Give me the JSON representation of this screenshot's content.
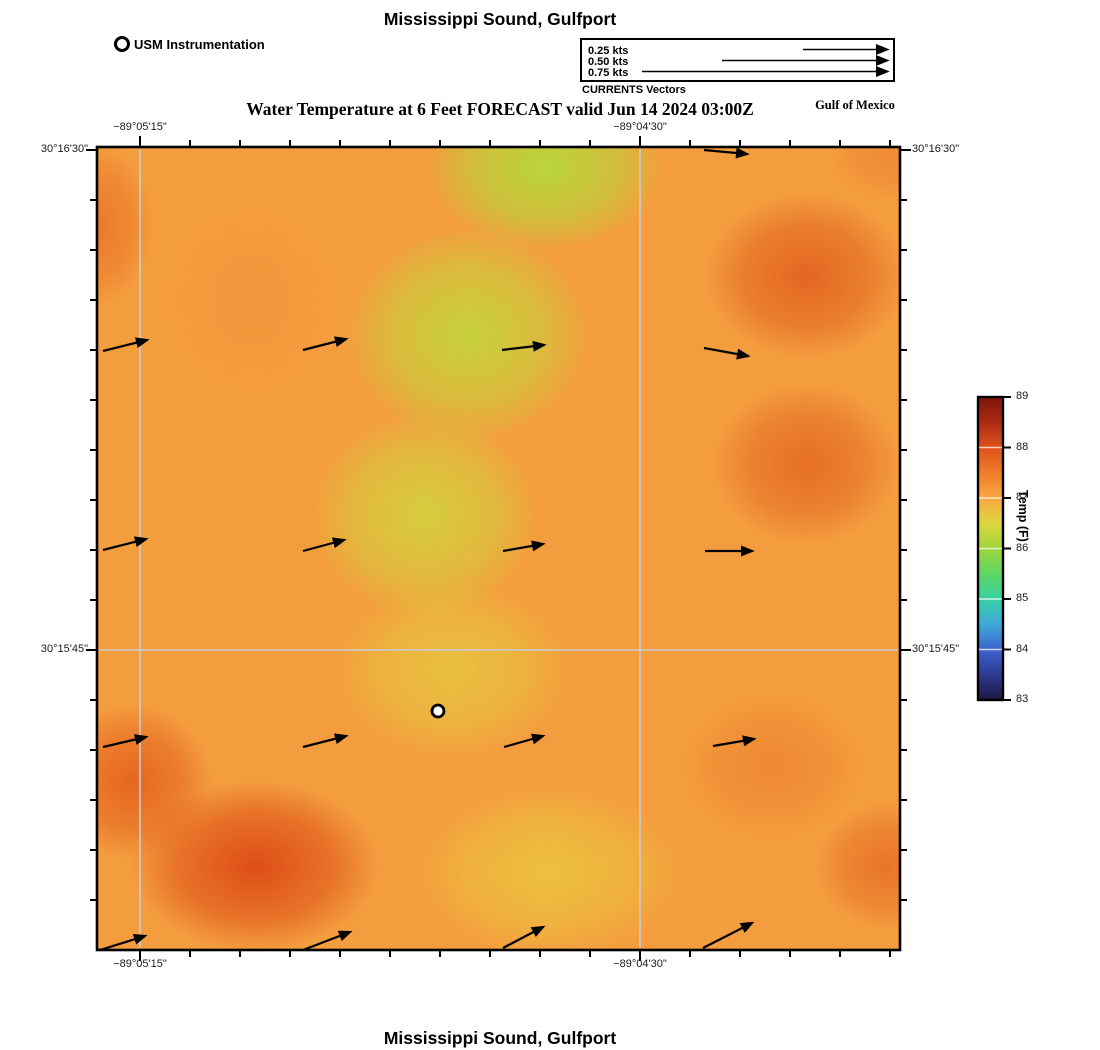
{
  "page": {
    "title_top": "Mississippi Sound, Gulfport",
    "title_bottom": "Mississippi Sound, Gulfport",
    "subtitle": "Water Temperature at 6 Feet FORECAST valid Jun 14 2024 03:00Z",
    "region_label": "Gulf of Mexico"
  },
  "instrument_legend": {
    "label": "USM Instrumentation"
  },
  "currents_legend": {
    "title": "CURRENTS Vectors",
    "head_x": 887,
    "row_ys": [
      49.5,
      60.5,
      71.5
    ],
    "entries": [
      {
        "label": "0.25 kts",
        "tail_x": 803
      },
      {
        "label": "0.50 kts",
        "tail_x": 722
      },
      {
        "label": "0.75 kts",
        "tail_x": 642
      }
    ]
  },
  "axes": {
    "minor_tick_step_px": 50,
    "top_ticks": [
      {
        "label": "−89°05'15\"",
        "x": 140
      },
      {
        "label": "−89°04'30\"",
        "x": 640
      }
    ],
    "bottom_ticks": [
      {
        "label": "−89°05'15\"",
        "x": 140
      },
      {
        "label": "−89°04'30\"",
        "x": 640
      }
    ],
    "left_ticks": [
      {
        "label": "30°16'30\"",
        "y": 150
      },
      {
        "label": "30°15'45\"",
        "y": 650
      }
    ],
    "right_ticks": [
      {
        "label": "30°16'30\"",
        "y": 150
      },
      {
        "label": "30°15'45\"",
        "y": 650
      }
    ],
    "gridlines_x": [
      140,
      640
    ],
    "gridlines_y": [
      650
    ]
  },
  "colorbar": {
    "label": "Temp (F)",
    "min": 83,
    "max": 89,
    "ticks": [
      83,
      84,
      85,
      86,
      87,
      88,
      89
    ],
    "colors_bottom_to_top": [
      "#1d1746",
      "#2c3a8e",
      "#3c64cf",
      "#3fa9da",
      "#38d0a4",
      "#5ed763",
      "#9fd63c",
      "#ddd63e",
      "#f9a743",
      "#f17c2b",
      "#df521c",
      "#ab2a13",
      "#7c150c"
    ],
    "geometry": {
      "left": 978,
      "top": 397,
      "width": 25,
      "height": 303
    }
  },
  "chart_data": {
    "type": "heatmap",
    "title": "Mississippi Sound, Gulfport",
    "subtitle": "Water Temperature at 6 Feet FORECAST valid Jun 14 2024 03:00Z",
    "value_label": "Temp (F)",
    "value_range": [
      83,
      89
    ],
    "x_axis_ticks": [
      "−89°05'15\"",
      "−89°04'30\""
    ],
    "y_axis_ticks": [
      "30°16'30\"",
      "30°15'45\""
    ],
    "plot_px": {
      "left": 97,
      "top": 147,
      "width": 803,
      "height": 803
    },
    "approx_temperature_regions_f": [
      {
        "region": "background field",
        "temp_f": 87.2
      },
      {
        "region": "diagonal band top-center to mid-left (green)",
        "temp_f": 86.2
      },
      {
        "region": "lower-center (yellow)",
        "temp_f": 86.7
      },
      {
        "region": "top-right blob",
        "temp_f": 87.9
      },
      {
        "region": "right-middle blob",
        "temp_f": 87.9
      },
      {
        "region": "left edge upper",
        "temp_f": 87.7
      },
      {
        "region": "bottom-left blob (darkest)",
        "temp_f": 88.3
      },
      {
        "region": "bottom-right corner",
        "temp_f": 87.8
      }
    ],
    "heat_base_color": "#f49d3e",
    "heat_blobs": [
      {
        "x": 545,
        "y": 168,
        "rx": 165,
        "ry": 115,
        "c": "#b4d93a",
        "a": 0.95
      },
      {
        "x": 468,
        "y": 335,
        "rx": 170,
        "ry": 150,
        "c": "#bfdb3b",
        "a": 0.85
      },
      {
        "x": 425,
        "y": 515,
        "rx": 160,
        "ry": 145,
        "c": "#ced93d",
        "a": 0.8
      },
      {
        "x": 452,
        "y": 670,
        "rx": 165,
        "ry": 125,
        "c": "#e2d340",
        "a": 0.65
      },
      {
        "x": 548,
        "y": 872,
        "rx": 185,
        "ry": 120,
        "c": "#eac93e",
        "a": 0.8
      },
      {
        "x": 806,
        "y": 276,
        "rx": 140,
        "ry": 115,
        "c": "#e05e1d",
        "a": 0.88
      },
      {
        "x": 806,
        "y": 464,
        "rx": 130,
        "ry": 112,
        "c": "#e2641f",
        "a": 0.82
      },
      {
        "x": 97,
        "y": 225,
        "rx": 78,
        "ry": 112,
        "c": "#ea7226",
        "a": 0.85
      },
      {
        "x": 255,
        "y": 866,
        "rx": 172,
        "ry": 118,
        "c": "#dc4a14",
        "a": 0.95
      },
      {
        "x": 133,
        "y": 782,
        "rx": 110,
        "ry": 108,
        "c": "#e05316",
        "a": 0.75
      },
      {
        "x": 886,
        "y": 866,
        "rx": 98,
        "ry": 88,
        "c": "#e66b22",
        "a": 0.8
      },
      {
        "x": 772,
        "y": 766,
        "rx": 125,
        "ry": 100,
        "c": "#ec7b29",
        "a": 0.6
      },
      {
        "x": 893,
        "y": 156,
        "rx": 88,
        "ry": 62,
        "c": "#ee8530",
        "a": 0.75
      },
      {
        "x": 250,
        "y": 300,
        "rx": 120,
        "ry": 130,
        "c": "#f0923a",
        "a": 0.5
      }
    ],
    "current_vectors_px": [
      {
        "x1": 704,
        "y1": 150,
        "x2": 747,
        "y2": 154
      },
      {
        "x1": 103,
        "y1": 351,
        "x2": 147,
        "y2": 340
      },
      {
        "x1": 303,
        "y1": 350,
        "x2": 346,
        "y2": 339
      },
      {
        "x1": 502,
        "y1": 350,
        "x2": 544,
        "y2": 345
      },
      {
        "x1": 704,
        "y1": 348,
        "x2": 748,
        "y2": 356
      },
      {
        "x1": 103,
        "y1": 550,
        "x2": 146,
        "y2": 539
      },
      {
        "x1": 303,
        "y1": 551,
        "x2": 344,
        "y2": 540
      },
      {
        "x1": 503,
        "y1": 551,
        "x2": 543,
        "y2": 544
      },
      {
        "x1": 705,
        "y1": 551,
        "x2": 752,
        "y2": 551
      },
      {
        "x1": 103,
        "y1": 747,
        "x2": 146,
        "y2": 737
      },
      {
        "x1": 303,
        "y1": 747,
        "x2": 346,
        "y2": 736
      },
      {
        "x1": 504,
        "y1": 747,
        "x2": 543,
        "y2": 736
      },
      {
        "x1": 713,
        "y1": 746,
        "x2": 754,
        "y2": 739
      },
      {
        "x1": 100,
        "y1": 950,
        "x2": 145,
        "y2": 936
      },
      {
        "x1": 303,
        "y1": 950,
        "x2": 350,
        "y2": 932
      },
      {
        "x1": 503,
        "y1": 948,
        "x2": 543,
        "y2": 927
      },
      {
        "x1": 703,
        "y1": 948,
        "x2": 752,
        "y2": 923
      }
    ],
    "instrument_marker_px": {
      "x": 438,
      "y": 711
    }
  }
}
